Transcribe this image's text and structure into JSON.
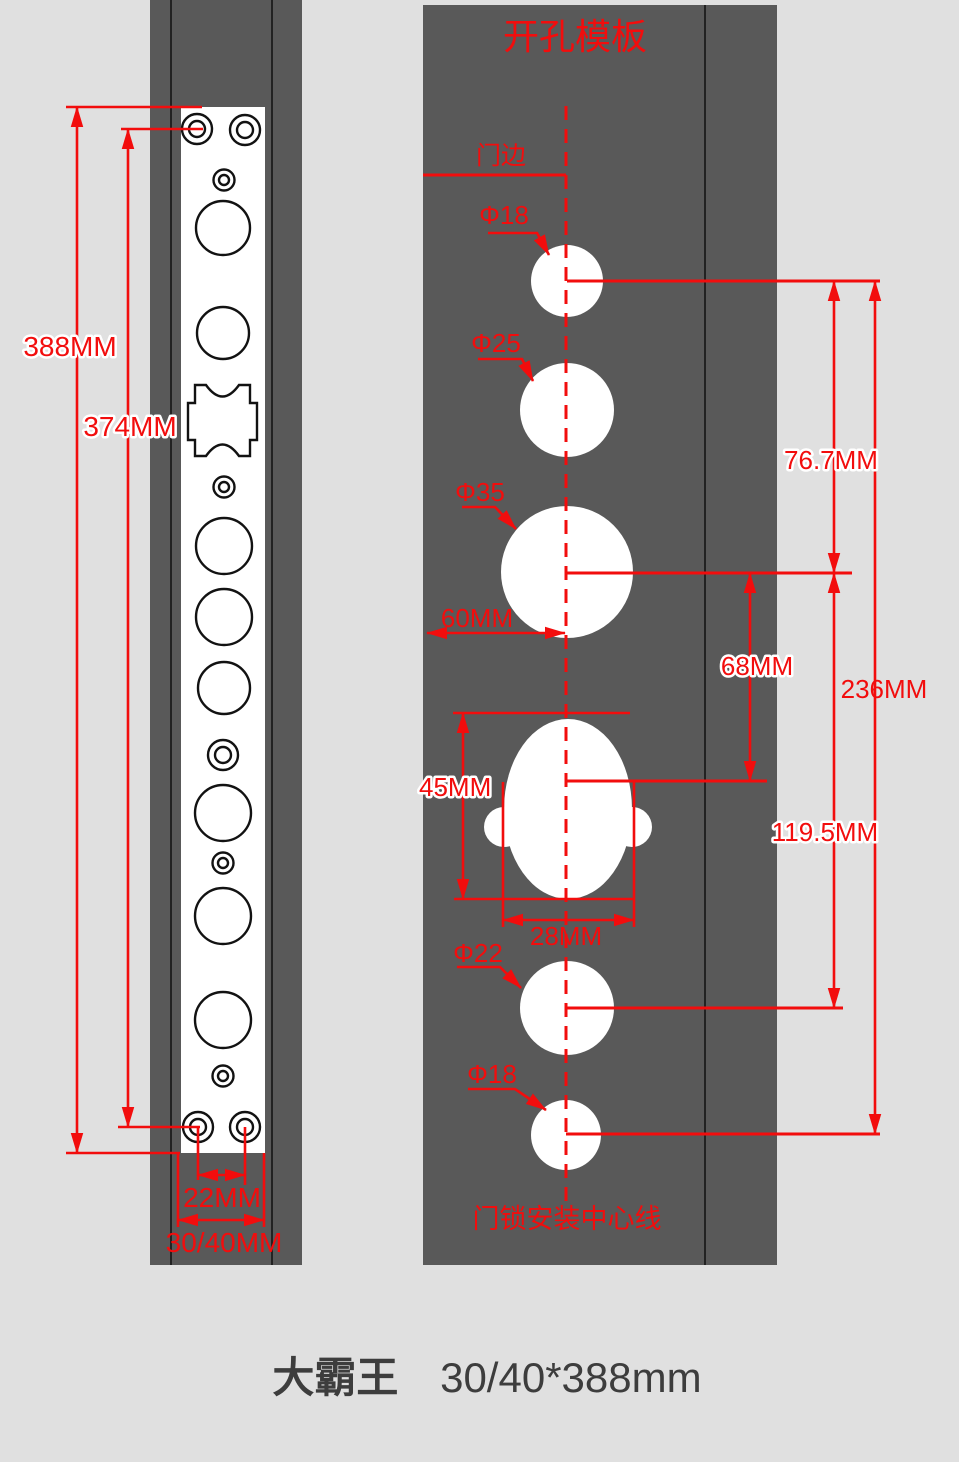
{
  "colors": {
    "accent_red": "#f20d0d",
    "panel_gray": "#595959",
    "background_gray": "#e0e0e0",
    "frame_line_black": "#151515",
    "hole_white": "#ffffff",
    "footer_text": "#3d3d3d"
  },
  "right_panel": {
    "title": "开孔模板",
    "door_edge_label": "门边",
    "install_centerline_label": "门锁安装中心线",
    "hole_labels": {
      "top_18": "Φ18",
      "h25": "Φ25",
      "h35": "Φ35",
      "h22": "Φ22",
      "bottom_18": "Φ18"
    },
    "dims": {
      "edge_offset": "60MM",
      "body_height": "45MM",
      "body_width": "28MM",
      "top18_to_35": "76.7MM",
      "c35_to_body": "68MM",
      "c35_to_22": "119.5MM",
      "overall_18_to_18": "236MM"
    }
  },
  "left_panel": {
    "dims": {
      "plate_length": "388MM",
      "screw_distance": "374MM",
      "screw_pair_span": "22MM",
      "plate_width": "30/40MM"
    }
  },
  "footer": {
    "product_name": "大霸王",
    "spec": "30/40*388mm"
  }
}
